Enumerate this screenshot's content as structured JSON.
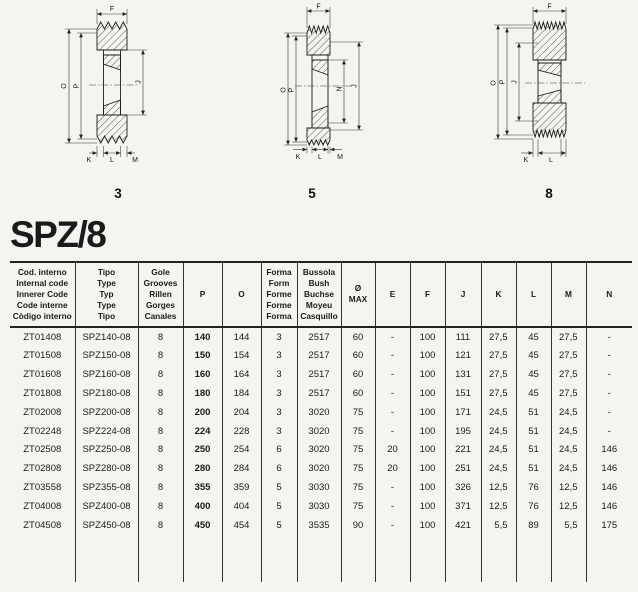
{
  "page": {
    "title": "SPZ/8"
  },
  "diagrams": [
    {
      "form_label": "3",
      "dims": {
        "top": "F",
        "left_outer": "O",
        "left_inner": "P",
        "right": "J",
        "bottom": [
          "K",
          "L",
          "M"
        ]
      }
    },
    {
      "form_label": "5",
      "dims": {
        "top": "F",
        "left_outer": "O",
        "left_inner": "P",
        "right_inner": "N",
        "right": "J",
        "bottom": [
          "K",
          "L",
          "M"
        ]
      }
    },
    {
      "form_label": "8",
      "dims": {
        "top": "F",
        "left_outer": "O",
        "left_inner": "P",
        "inner": "J",
        "bottom": [
          "K",
          "L"
        ]
      }
    }
  ],
  "table": {
    "headers": [
      {
        "lines": [
          "Cod. interno",
          "Internal code",
          "Innerer Code",
          "Code interne",
          "Còdigo interno"
        ]
      },
      {
        "lines": [
          "Tipo",
          "Type",
          "Typ",
          "Type",
          "Tipo"
        ]
      },
      {
        "lines": [
          "Gole",
          "Grooves",
          "Rillen",
          "Gorges",
          "Canales"
        ]
      },
      {
        "lines": [
          "P"
        ]
      },
      {
        "lines": [
          "O"
        ]
      },
      {
        "lines": [
          "Forma",
          "Form",
          "Forme",
          "Forme",
          "Forma"
        ]
      },
      {
        "lines": [
          "Bussola",
          "Bush",
          "Buchse",
          "Moyeu",
          "Casquillo"
        ]
      },
      {
        "lines": [
          "Ø",
          "MAX"
        ]
      },
      {
        "lines": [
          "E"
        ]
      },
      {
        "lines": [
          "F"
        ]
      },
      {
        "lines": [
          "J"
        ]
      },
      {
        "lines": [
          "K"
        ]
      },
      {
        "lines": [
          "L"
        ]
      },
      {
        "lines": [
          "M"
        ]
      },
      {
        "lines": [
          "N"
        ]
      }
    ],
    "rows": [
      [
        "ZT01408",
        "SPZ140-08",
        "8",
        "140",
        "144",
        "3",
        "2517",
        "60",
        "-",
        "100",
        "111",
        "27,5",
        "45",
        "27,5",
        "-"
      ],
      [
        "ZT01508",
        "SPZ150-08",
        "8",
        "150",
        "154",
        "3",
        "2517",
        "60",
        "-",
        "100",
        "121",
        "27,5",
        "45",
        "27,5",
        "-"
      ],
      [
        "ZT01608",
        "SPZ160-08",
        "8",
        "160",
        "164",
        "3",
        "2517",
        "60",
        "-",
        "100",
        "131",
        "27,5",
        "45",
        "27,5",
        "-"
      ],
      [
        "ZT01808",
        "SPZ180-08",
        "8",
        "180",
        "184",
        "3",
        "2517",
        "60",
        "-",
        "100",
        "151",
        "27,5",
        "45",
        "27,5",
        "-"
      ],
      [
        "ZT02008",
        "SPZ200-08",
        "8",
        "200",
        "204",
        "3",
        "3020",
        "75",
        "-",
        "100",
        "171",
        "24,5",
        "51",
        "24,5",
        "-"
      ],
      [
        "ZT02248",
        "SPZ224-08",
        "8",
        "224",
        "228",
        "3",
        "3020",
        "75",
        "-",
        "100",
        "195",
        "24,5",
        "51",
        "24,5",
        "-"
      ],
      [
        "ZT02508",
        "SPZ250-08",
        "8",
        "250",
        "254",
        "6",
        "3020",
        "75",
        "20",
        "100",
        "221",
        "24,5",
        "51",
        "24,5",
        "146"
      ],
      [
        "ZT02808",
        "SPZ280-08",
        "8",
        "280",
        "284",
        "6",
        "3020",
        "75",
        "20",
        "100",
        "251",
        "24,5",
        "51",
        "24,5",
        "146"
      ],
      [
        "ZT03558",
        "SPZ355-08",
        "8",
        "355",
        "359",
        "5",
        "3030",
        "75",
        "-",
        "100",
        "326",
        "12,5",
        "76",
        "12,5",
        "146"
      ],
      [
        "ZT04008",
        "SPZ400-08",
        "8",
        "400",
        "404",
        "5",
        "3030",
        "75",
        "-",
        "100",
        "371",
        "12,5",
        "76",
        "12,5",
        "146"
      ],
      [
        "ZT04508",
        "SPZ450-08",
        "8",
        "450",
        "454",
        "5",
        "3535",
        "90",
        "-",
        "100",
        "421",
        "5,5",
        "89",
        "5,5",
        "175"
      ]
    ]
  }
}
